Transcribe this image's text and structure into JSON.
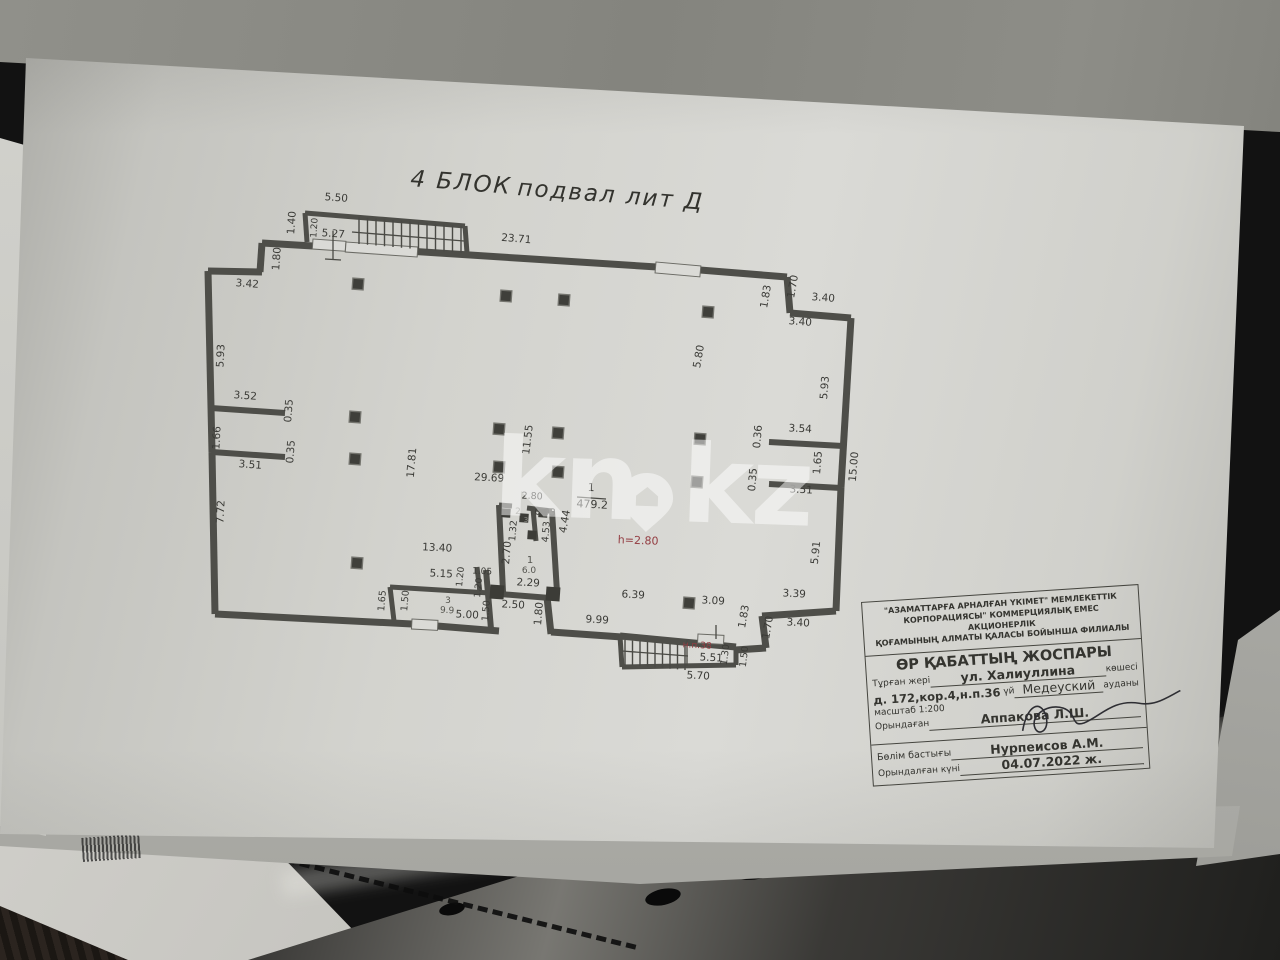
{
  "title": {
    "left": "4 БЛОК",
    "right": "подвал лит Д"
  },
  "watermark": {
    "left": "kn",
    "right": "kz",
    "icon": "map-pin-house-icon",
    "color": "#ffffff"
  },
  "plan": {
    "colors": {
      "wall": "#4e4e49",
      "ink": "#3b3b37",
      "red": "#943d42",
      "light": "#8d8d87",
      "mid": "#55554f",
      "paper": "#dadad6"
    },
    "room_main": {
      "number": "1",
      "area": "479.2",
      "height_note": "h=2.80"
    },
    "stair_label": "н.п.38",
    "walls": [
      [
        262,
        243,
        313,
        246,
        7
      ],
      [
        345,
        247,
        657,
        267,
        7
      ],
      [
        700,
        270,
        787,
        277,
        7
      ],
      [
        787,
        277,
        790,
        313,
        7
      ],
      [
        790,
        313,
        851,
        318,
        7
      ],
      [
        851,
        318,
        841,
        487,
        7
      ],
      [
        841,
        487,
        836,
        611,
        7
      ],
      [
        836,
        611,
        762,
        616,
        7
      ],
      [
        762,
        616,
        766,
        648,
        7
      ],
      [
        766,
        648,
        735,
        650,
        7
      ],
      [
        620,
        636,
        736,
        647,
        7
      ],
      [
        551,
        632,
        622,
        637,
        7
      ],
      [
        547,
        597,
        551,
        634,
        7
      ],
      [
        500,
        594,
        550,
        598,
        6
      ],
      [
        215,
        614,
        412,
        624,
        7
      ],
      [
        437,
        626,
        499,
        631,
        7
      ],
      [
        208,
        271,
        262,
        272,
        7
      ],
      [
        262,
        243,
        260,
        272,
        7
      ],
      [
        208,
        271,
        212,
        452,
        7
      ],
      [
        212,
        452,
        215,
        614,
        7
      ],
      [
        211,
        408,
        285,
        413,
        6
      ],
      [
        212,
        452,
        285,
        457,
        6
      ],
      [
        769,
        442,
        843,
        446,
        6
      ],
      [
        769,
        484,
        841,
        488,
        6
      ],
      [
        390,
        587,
        490,
        593,
        5
      ],
      [
        390,
        587,
        394,
        621,
        5
      ],
      [
        486,
        570,
        491,
        629,
        6
      ],
      [
        477,
        567,
        480,
        593,
        5
      ],
      [
        499,
        505,
        503,
        592,
        6
      ],
      [
        499,
        505,
        512,
        506,
        5
      ],
      [
        527,
        508,
        552,
        511,
        5
      ],
      [
        552,
        511,
        557,
        592,
        6
      ],
      [
        533,
        509,
        536,
        541,
        5
      ],
      [
        305,
        213,
        307,
        242,
        5
      ],
      [
        305,
        213,
        465,
        226,
        5
      ],
      [
        465,
        226,
        467,
        253,
        5
      ],
      [
        620,
        636,
        622,
        667,
        5
      ],
      [
        622,
        667,
        736,
        665,
        5
      ],
      [
        736,
        665,
        736,
        647,
        5
      ]
    ],
    "thin_lines": [
      [
        577,
        497,
        606,
        499
      ],
      [
        333,
        231,
        333,
        259
      ],
      [
        325,
        259,
        341,
        260
      ],
      [
        352,
        232,
        464,
        241
      ],
      [
        622,
        651,
        688,
        656
      ],
      [
        687,
        640,
        687,
        666
      ],
      [
        716,
        625,
        716,
        639
      ]
    ],
    "stairs": [
      {
        "x1": 359,
        "y1": 217,
        "x2": 461,
        "y2": 226,
        "drop": 27,
        "count": 13
      },
      {
        "x1": 625,
        "y1": 640,
        "x2": 685,
        "y2": 645,
        "drop": 25,
        "count": 9
      }
    ],
    "openings": [
      [
        313,
        239,
        33,
        10,
        4
      ],
      [
        346,
        242,
        72,
        10,
        4
      ],
      [
        656,
        262,
        45,
        11,
        5
      ],
      [
        412,
        619,
        26,
        10,
        3
      ],
      [
        698,
        634,
        26,
        9,
        3
      ]
    ],
    "columns": [
      [
        358,
        284
      ],
      [
        506,
        296
      ],
      [
        564,
        300
      ],
      [
        708,
        312
      ],
      [
        355,
        417
      ],
      [
        499,
        429
      ],
      [
        558,
        433
      ],
      [
        700,
        439
      ],
      [
        355,
        459
      ],
      [
        499,
        467
      ],
      [
        558,
        472
      ],
      [
        697,
        482
      ],
      [
        357,
        563
      ],
      [
        689,
        603
      ]
    ],
    "piers": [
      [
        506,
        513,
        9
      ],
      [
        524,
        518,
        9
      ],
      [
        543,
        513,
        9
      ],
      [
        532,
        535,
        9
      ],
      [
        497,
        592,
        14
      ],
      [
        553,
        594,
        14
      ]
    ],
    "dims": [
      {
        "t": "5.50",
        "x": 336,
        "y": 201,
        "r": 4
      },
      {
        "t": "1.40",
        "x": 295,
        "y": 223,
        "r": -86
      },
      {
        "t": "1.20",
        "x": 317,
        "y": 228,
        "r": -86,
        "s": 9
      },
      {
        "t": "5.27",
        "x": 333,
        "y": 237,
        "r": 4
      },
      {
        "t": "1.80",
        "x": 280,
        "y": 259,
        "r": -86
      },
      {
        "t": "23.71",
        "x": 516,
        "y": 242,
        "r": 5
      },
      {
        "t": "3.42",
        "x": 247,
        "y": 287,
        "r": 4
      },
      {
        "t": "5.93",
        "x": 224,
        "y": 356,
        "r": -87
      },
      {
        "t": "3.52",
        "x": 245,
        "y": 399,
        "r": 4
      },
      {
        "t": "0.35",
        "x": 292,
        "y": 411,
        "r": -86
      },
      {
        "t": "1.66",
        "x": 220,
        "y": 438,
        "r": -87
      },
      {
        "t": "0.35",
        "x": 294,
        "y": 452,
        "r": -86
      },
      {
        "t": "3.51",
        "x": 250,
        "y": 468,
        "r": 4
      },
      {
        "t": "7.72",
        "x": 224,
        "y": 512,
        "r": -87
      },
      {
        "t": "17.81",
        "x": 415,
        "y": 463,
        "r": -85
      },
      {
        "t": "29.69",
        "x": 489,
        "y": 481,
        "r": 3
      },
      {
        "t": "11.55",
        "x": 531,
        "y": 440,
        "r": -83
      },
      {
        "t": "13.40",
        "x": 437,
        "y": 551,
        "r": 3
      },
      {
        "t": "5.15",
        "x": 441,
        "y": 577,
        "r": 3
      },
      {
        "t": "1.20",
        "x": 463,
        "y": 577,
        "r": -84,
        "s": 9
      },
      {
        "t": "1.05",
        "x": 482,
        "y": 574,
        "r": 3,
        "s": 9
      },
      {
        "t": "1.20",
        "x": 481,
        "y": 588,
        "r": -84,
        "s": 9
      },
      {
        "t": "2.80",
        "x": 532,
        "y": 499,
        "r": 3,
        "s": 9.5
      },
      {
        "t": "0.93",
        "x": 545,
        "y": 515,
        "r": 3,
        "s": 9.5
      },
      {
        "t": "1.32",
        "x": 516,
        "y": 531,
        "r": -85,
        "s": 9.5
      },
      {
        "t": "4.53",
        "x": 549,
        "y": 532,
        "r": -85,
        "s": 9.5
      },
      {
        "t": "4.44",
        "x": 568,
        "y": 522,
        "r": -80
      },
      {
        "t": "2.70",
        "x": 510,
        "y": 553,
        "r": -85
      },
      {
        "t": "2.29",
        "x": 528,
        "y": 586,
        "r": 3
      },
      {
        "t": "2.50",
        "x": 513,
        "y": 608,
        "r": 3
      },
      {
        "t": "1.50",
        "x": 489,
        "y": 611,
        "r": -85,
        "s": 9.5
      },
      {
        "t": "1.80",
        "x": 542,
        "y": 614,
        "r": -85
      },
      {
        "t": "1.65",
        "x": 385,
        "y": 601,
        "r": -85,
        "s": 9.5
      },
      {
        "t": "1.50",
        "x": 408,
        "y": 601,
        "r": -85,
        "s": 9.5
      },
      {
        "t": "5.00",
        "x": 467,
        "y": 618,
        "r": 3
      },
      {
        "t": "9.99",
        "x": 597,
        "y": 623,
        "r": 3
      },
      {
        "t": "6.39",
        "x": 633,
        "y": 598,
        "r": 3
      },
      {
        "t": "3.09",
        "x": 713,
        "y": 604,
        "r": 3
      },
      {
        "t": "1.83",
        "x": 747,
        "y": 617,
        "r": -80
      },
      {
        "t": "5.80",
        "x": 702,
        "y": 357,
        "r": -80
      },
      {
        "t": "1.83",
        "x": 769,
        "y": 297,
        "r": -80
      },
      {
        "t": "1.70",
        "x": 796,
        "y": 287,
        "r": -80
      },
      {
        "t": "3.40",
        "x": 823,
        "y": 301,
        "r": 4
      },
      {
        "t": "3.40",
        "x": 800,
        "y": 325,
        "r": 4
      },
      {
        "t": "5.93",
        "x": 828,
        "y": 388,
        "r": -85
      },
      {
        "t": "15.00",
        "x": 857,
        "y": 467,
        "r": -85
      },
      {
        "t": "3.54",
        "x": 800,
        "y": 432,
        "r": 3
      },
      {
        "t": "0.36",
        "x": 761,
        "y": 437,
        "r": -85
      },
      {
        "t": "1.65",
        "x": 821,
        "y": 463,
        "r": -85
      },
      {
        "t": "0.35",
        "x": 756,
        "y": 480,
        "r": -85
      },
      {
        "t": "3.51",
        "x": 801,
        "y": 493,
        "r": 3
      },
      {
        "t": "5.91",
        "x": 819,
        "y": 553,
        "r": -84
      },
      {
        "t": "3.39",
        "x": 794,
        "y": 597,
        "r": 3
      },
      {
        "t": "1.70",
        "x": 771,
        "y": 628,
        "r": -80
      },
      {
        "t": "3.40",
        "x": 798,
        "y": 626,
        "r": 3
      },
      {
        "t": "5.51",
        "x": 711,
        "y": 661,
        "r": 3
      },
      {
        "t": "1.30",
        "x": 728,
        "y": 655,
        "r": -83,
        "s": 9.5
      },
      {
        "t": "1.50",
        "x": 747,
        "y": 657,
        "r": -83,
        "s": 9.5
      },
      {
        "t": "5.70",
        "x": 698,
        "y": 679,
        "r": 3
      },
      {
        "t": "1",
        "x": 591,
        "y": 491,
        "r": 3,
        "s": 11
      },
      {
        "t": "479.2",
        "x": 592,
        "y": 508,
        "r": 3,
        "s": 11
      },
      {
        "t": "h=2.80",
        "x": 638,
        "y": 544,
        "r": 2,
        "s": 11,
        "c": "red"
      },
      {
        "t": "н.п.38",
        "x": 697,
        "y": 648,
        "r": 3,
        "s": 9,
        "c": "red"
      },
      {
        "t": "2",
        "x": 518,
        "y": 514,
        "r": 0,
        "s": 9,
        "c": "light"
      },
      {
        "t": "3",
        "x": 526,
        "y": 522,
        "r": 0,
        "s": 7,
        "c": "light"
      },
      {
        "t": "1",
        "x": 530,
        "y": 563,
        "r": 0,
        "s": 10,
        "c": "mid"
      },
      {
        "t": "6.0",
        "x": 529,
        "y": 573,
        "r": 0,
        "s": 9,
        "c": "mid"
      },
      {
        "t": "3",
        "x": 448,
        "y": 603,
        "r": 0,
        "s": 9,
        "c": "mid"
      },
      {
        "t": "9.9",
        "x": 447,
        "y": 613,
        "r": 3,
        "s": 9,
        "c": "mid"
      }
    ]
  },
  "stamp": {
    "org": "\"АЗАМАТТАРҒА АРНАЛҒАН ҮКІМЕТ\" МЕМЛЕКЕТТІК\nКОРПОРАЦИЯСЫ\" КОММЕРЦИЯЛЫҚ ЕМЕС АКЦИОНЕРЛІК\nҚОҒАМЫНЫҢ АЛМАТЫ ҚАЛАСЫ БОЙЫНША ФИЛИАЛЫ",
    "doc_title": "ӨР ҚАБАТТЫҢ ЖОСПАРЫ",
    "location_label": "Тұрған жері",
    "street": "ул. Халиуллина",
    "street_suffix": "көшесі",
    "building": "д. 172,кор.4,н.п.36",
    "house_suffix": "үй",
    "district": "Медеуский",
    "district_suffix": "ауданы",
    "scale": "масштаб 1:200",
    "executor_label": "Орындаған",
    "executor_name": "Аппакова Л.Ш.",
    "head_label": "Бөлім бастығы",
    "head_name": "Нурпеисов А.М.",
    "date_label": "Орындалған күні",
    "date_value": "04.07.2022 ж."
  }
}
